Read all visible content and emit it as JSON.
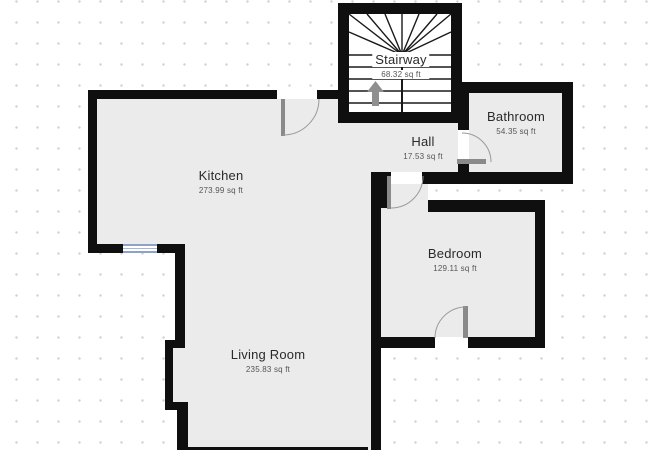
{
  "plan": {
    "type": "floor-plan",
    "rooms": [
      {
        "id": "stairway",
        "name": "Stairway",
        "area": "68.32 sq ft"
      },
      {
        "id": "hall",
        "name": "Hall",
        "area": "17.53 sq ft"
      },
      {
        "id": "bathroom",
        "name": "Bathroom",
        "area": "54.35 sq ft"
      },
      {
        "id": "kitchen",
        "name": "Kitchen",
        "area": "273.99 sq ft"
      },
      {
        "id": "bedroom",
        "name": "Bedroom",
        "area": "129.11 sq ft"
      },
      {
        "id": "living_room",
        "name": "Living Room",
        "area": "235.83 sq ft"
      }
    ],
    "features": {
      "door_count": 4,
      "window_count": 1,
      "stair_direction_icon": "up-arrow"
    },
    "colors": {
      "wall": "#0f0f0f",
      "floor": "#ebebeb",
      "stair_floor": "#ffffff",
      "background": "#ffffff",
      "grid_dot": "#d2d2d2",
      "door_leaf": "#8a8a8a",
      "door_arc": "#9a9a9a",
      "window_frame": "#8fa0cc",
      "arrow": "#8f8f8f",
      "room_name_text": "#2a2a2a",
      "area_text": "#555555"
    }
  }
}
